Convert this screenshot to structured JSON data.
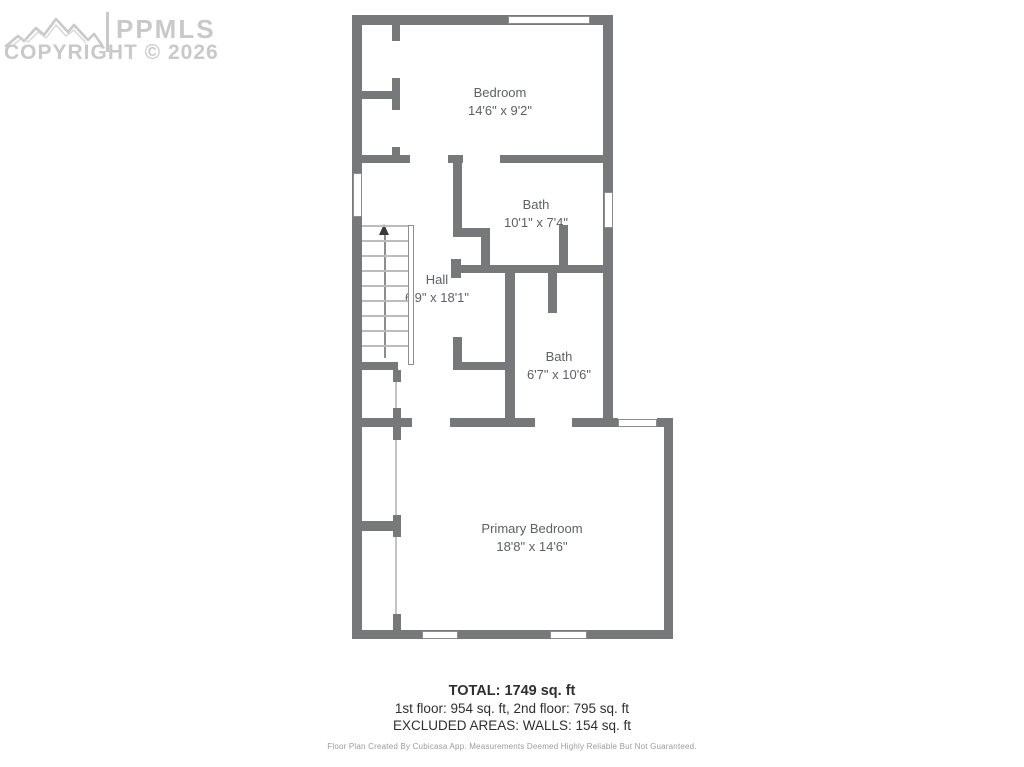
{
  "watermark": {
    "brand": "PPMLS",
    "copyright": "COPYRIGHT © 2026"
  },
  "floorplan": {
    "rooms": [
      {
        "name": "Bedroom",
        "dims": "14'6\" x 9'2\""
      },
      {
        "name": "Bath",
        "dims": "10'1\" x 7'4\""
      },
      {
        "name": "Hall",
        "dims": "6'9\" x 18'1\""
      },
      {
        "name": "Bath",
        "dims": "6'7\" x 10'6\""
      },
      {
        "name": "Primary Bedroom",
        "dims": "18'8\" x 14'6\""
      }
    ]
  },
  "summary": {
    "total": "TOTAL: 1749 sq. ft",
    "floors": "1st floor: 954 sq. ft, 2nd floor: 795 sq. ft",
    "excluded": "EXCLUDED AREAS: WALLS: 154 sq. ft",
    "disclaimer": "Floor Plan Created By Cubicasa App. Measurements Deemed Highly Reliable But Not Guaranteed."
  },
  "colors": {
    "wall": "#77787a",
    "thin_partition": "#c4c4c4",
    "stair_tread": "#bcbcbc",
    "window_border": "#8d8d8d",
    "room_label": "#5d6064",
    "summary_text": "#2f2f2f",
    "disclaimer_text": "#9b9b9b",
    "watermark": "#c9c9c9",
    "stair_arrow": "#3a3a3a"
  }
}
